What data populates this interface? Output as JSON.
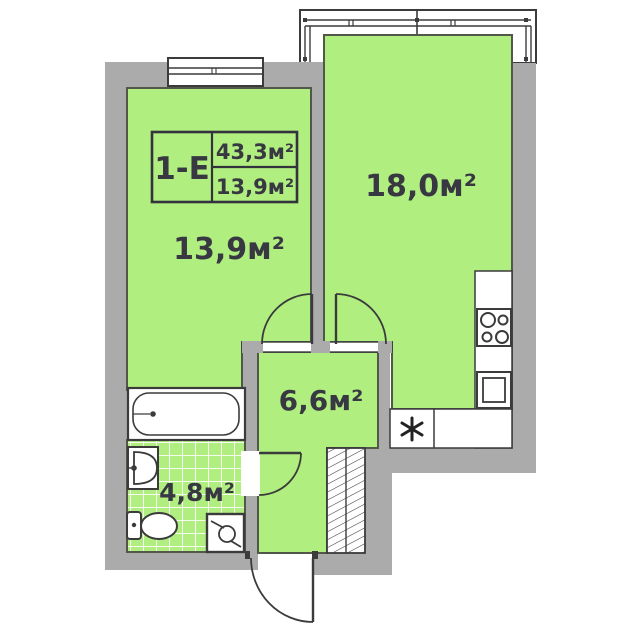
{
  "floor_plan": {
    "unit": {
      "code": "1-E",
      "total_area": "43,3м²",
      "living_area": "13,9м²"
    },
    "rooms": [
      {
        "name": "living-room",
        "area": "13,9м²"
      },
      {
        "name": "kitchen-living-room",
        "area": "18,0м²"
      },
      {
        "name": "hallway",
        "area": "6,6м²"
      },
      {
        "name": "bathroom",
        "area": "4,8м²"
      }
    ],
    "fixtures": [
      "balcony-glazing",
      "window",
      "bathtub",
      "washbasin",
      "toilet",
      "washing-machine",
      "wardrobe-hatch",
      "stove-4-burners",
      "kitchen-sink",
      "refrigerator-asterisk",
      "entrance-door",
      "room-doors",
      "bathroom-door"
    ],
    "colors": {
      "background": "#ffffff",
      "wall": "#ababab",
      "room_fill": "#b0ee80",
      "room_outline": "#51584a",
      "line": "#3b3b3b",
      "text": "#383842"
    }
  }
}
